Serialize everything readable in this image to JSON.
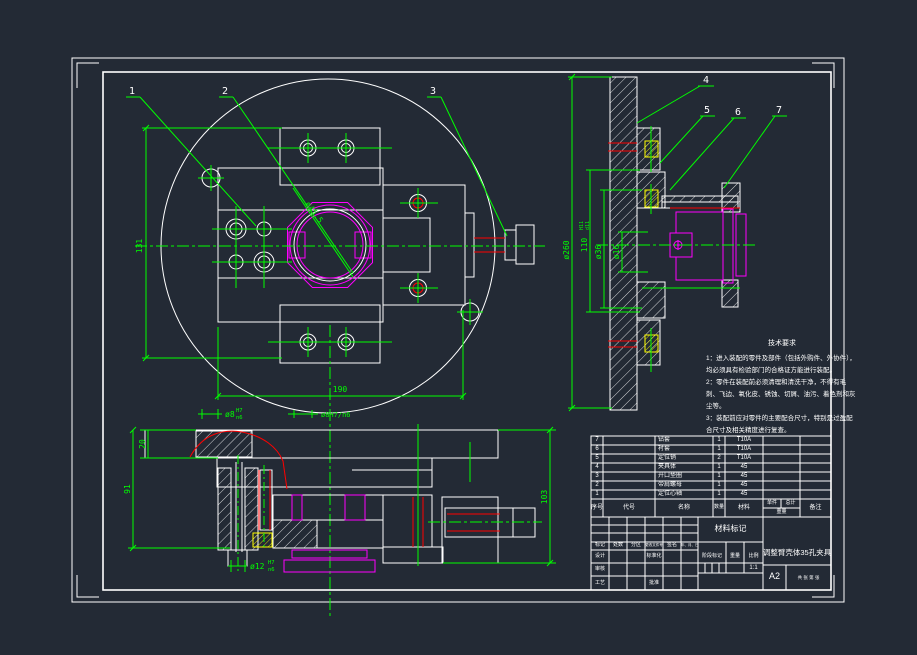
{
  "drawing": {
    "balloons": [
      "1",
      "2",
      "3",
      "4",
      "5",
      "6",
      "7"
    ],
    "view_plan": {
      "dim_height": "131",
      "dim_width": "190",
      "dim_bore": "ø45.5",
      "dim_pin_fit": "ø8H7/n6"
    },
    "view_side": {
      "dim_disc": "ø260",
      "dim_spigot": "110",
      "dim_spigot_fit_upper": "H11",
      "dim_spigot_fit_lower": "d11",
      "dim_d36": "ø36",
      "dim_d16": "ø16"
    },
    "view_front": {
      "dim_plate": "20",
      "dim_91": "91",
      "dim_103": "103",
      "dim_bush8": "ø8",
      "dim_bush8_fit_upper": "H7",
      "dim_bush8_fit_lower": "n6",
      "dim_bush12": "ø12",
      "dim_bush12_fit_upper": "H7",
      "dim_bush12_fit_lower": "n6"
    }
  },
  "notes": {
    "title": "技术要求",
    "items": [
      "1：进入装配的零件及部件（包括外购件、外协件），均必须具有检验部门的合格证方能进行装配。",
      "2：零件在装配前必须清理和清洗干净，不得有毛刺、飞边、氧化皮、锈蚀、切屑、油污、着色剂和灰尘等。",
      "3：装配前应对零件的主要配合尺寸，特别是过盈配合尺寸及相关精度进行复查。"
    ]
  },
  "parts_table": {
    "headers": {
      "no": "序号",
      "code": "代号",
      "name": "名称",
      "qty": "数量",
      "material": "材料",
      "weight_unit": "单件",
      "weight_total": "总计",
      "weight": "重量",
      "remark": "备注"
    },
    "rows": [
      {
        "no": "7",
        "name": "钻套",
        "qty": "1",
        "material": "T10A"
      },
      {
        "no": "6",
        "name": "衬套",
        "qty": "1",
        "material": "T10A"
      },
      {
        "no": "5",
        "name": "定位销",
        "qty": "2",
        "material": "T10A"
      },
      {
        "no": "4",
        "name": "夹具体",
        "qty": "1",
        "material": "45"
      },
      {
        "no": "3",
        "name": "开口垫圈",
        "qty": "1",
        "material": "45"
      },
      {
        "no": "2",
        "name": "带肩螺母",
        "qty": "1",
        "material": "45"
      },
      {
        "no": "1",
        "name": "定位心轴",
        "qty": "1",
        "material": "45"
      }
    ]
  },
  "title_block": {
    "material_mark": "材料标记",
    "title": "调整臂壳体35孔夹具",
    "rev_row": {
      "mark": "标记",
      "count": "处数",
      "zone": "分区",
      "file": "更改文件号",
      "sign": "签名",
      "date": "年、月、日"
    },
    "roles": {
      "design": "设计",
      "standard": "标准化",
      "check": "审核",
      "process": "工艺",
      "approve": "批准"
    },
    "stage": {
      "stage_mark": "阶段标记",
      "weight": "重量",
      "scale": "比例",
      "scale_value": "1:1"
    },
    "sheet": {
      "info": "共  张  第  张",
      "size": "A2"
    }
  }
}
